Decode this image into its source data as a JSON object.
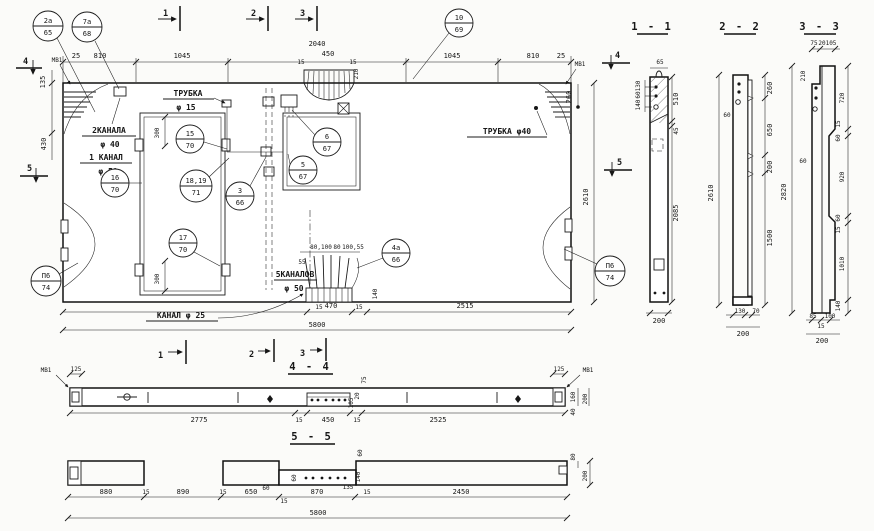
{
  "app": {
    "background": "#fbfbf9",
    "ink": "#1b1b1b"
  },
  "plan": {
    "mv1": "МВ1",
    "marks": {
      "m1": "1",
      "m2": "2",
      "m3": "3",
      "m4": "4",
      "m5": "5"
    },
    "top": [
      "25",
      "810",
      "1045",
      "2040",
      "15",
      "450",
      "15",
      "210",
      "1045",
      "810",
      "25"
    ],
    "left": [
      "135",
      "430"
    ],
    "right": [
      "260",
      "2610"
    ],
    "bottom": [
      "15",
      "470",
      "15",
      "2515",
      "5800",
      "140"
    ],
    "inner": [
      "300",
      "300"
    ],
    "fan": [
      "55",
      "80,100",
      "80",
      "100,55"
    ],
    "callouts": {
      "c2a": {
        "t": "2а",
        "b": "65"
      },
      "c7a": {
        "t": "7а",
        "b": "68"
      },
      "c10": {
        "t": "10",
        "b": "69"
      },
      "c15": {
        "t": "15",
        "b": "70"
      },
      "c1819": {
        "t": "18,19",
        "b": "71"
      },
      "c3": {
        "t": "3",
        "b": "66"
      },
      "c6": {
        "t": "6",
        "b": "67"
      },
      "c5": {
        "t": "5",
        "b": "67"
      },
      "c17": {
        "t": "17",
        "b": "70"
      },
      "c16": {
        "t": "16",
        "b": "70"
      },
      "c4a": {
        "t": "4а",
        "b": "66"
      },
      "cp6": {
        "t": "П6",
        "b": "74"
      }
    },
    "notes": {
      "trubka15a": "ТРУБКА",
      "trubka15b": "φ 15",
      "trubka40": "ТРУБКА  φ40",
      "kan2a": "2КАНАЛА",
      "kan2b": "φ 40",
      "kan1a": "1 КАНАЛ",
      "kan1b": "φ 50",
      "kan5a": "5КАНАЛОВ",
      "kan5b": "φ 50",
      "kan25": "КАНАЛ φ 25"
    }
  },
  "s11": {
    "title": "1 - 1",
    "w": "65",
    "stack": [
      "130",
      "60",
      "140"
    ],
    "right": [
      "510",
      "45",
      "2085"
    ],
    "bottom": "200"
  },
  "s22": {
    "title": "2 - 2",
    "left": [
      "2610",
      "60"
    ],
    "right": [
      "260",
      "650",
      "200",
      "1500"
    ],
    "bottom": [
      "130",
      "70",
      "200"
    ]
  },
  "s33": {
    "title": "3 - 3",
    "top": [
      "75",
      "20",
      "105"
    ],
    "t210": "210",
    "left": [
      "2820",
      "60"
    ],
    "right": [
      "720",
      "15",
      "60",
      "920",
      "60",
      "15",
      "1010",
      "140"
    ],
    "bottom": [
      "85",
      "15",
      "100",
      "200"
    ]
  },
  "s44": {
    "title": "4 - 4",
    "mv1": "МВ1",
    "l125": "125",
    "r125": "125",
    "bottom": [
      "2775",
      "15",
      "450",
      "15",
      "2525"
    ],
    "rv": [
      "160",
      "40",
      "200"
    ],
    "mid": [
      "75",
      "20",
      "105"
    ]
  },
  "s55": {
    "title": "5 - 5",
    "bottom": [
      "880",
      "15",
      "890",
      "15",
      "650",
      "15",
      "870",
      "135",
      "15",
      "2450"
    ],
    "total": "5800",
    "v": [
      "60",
      "60",
      "60",
      "140",
      "80",
      "200"
    ]
  }
}
